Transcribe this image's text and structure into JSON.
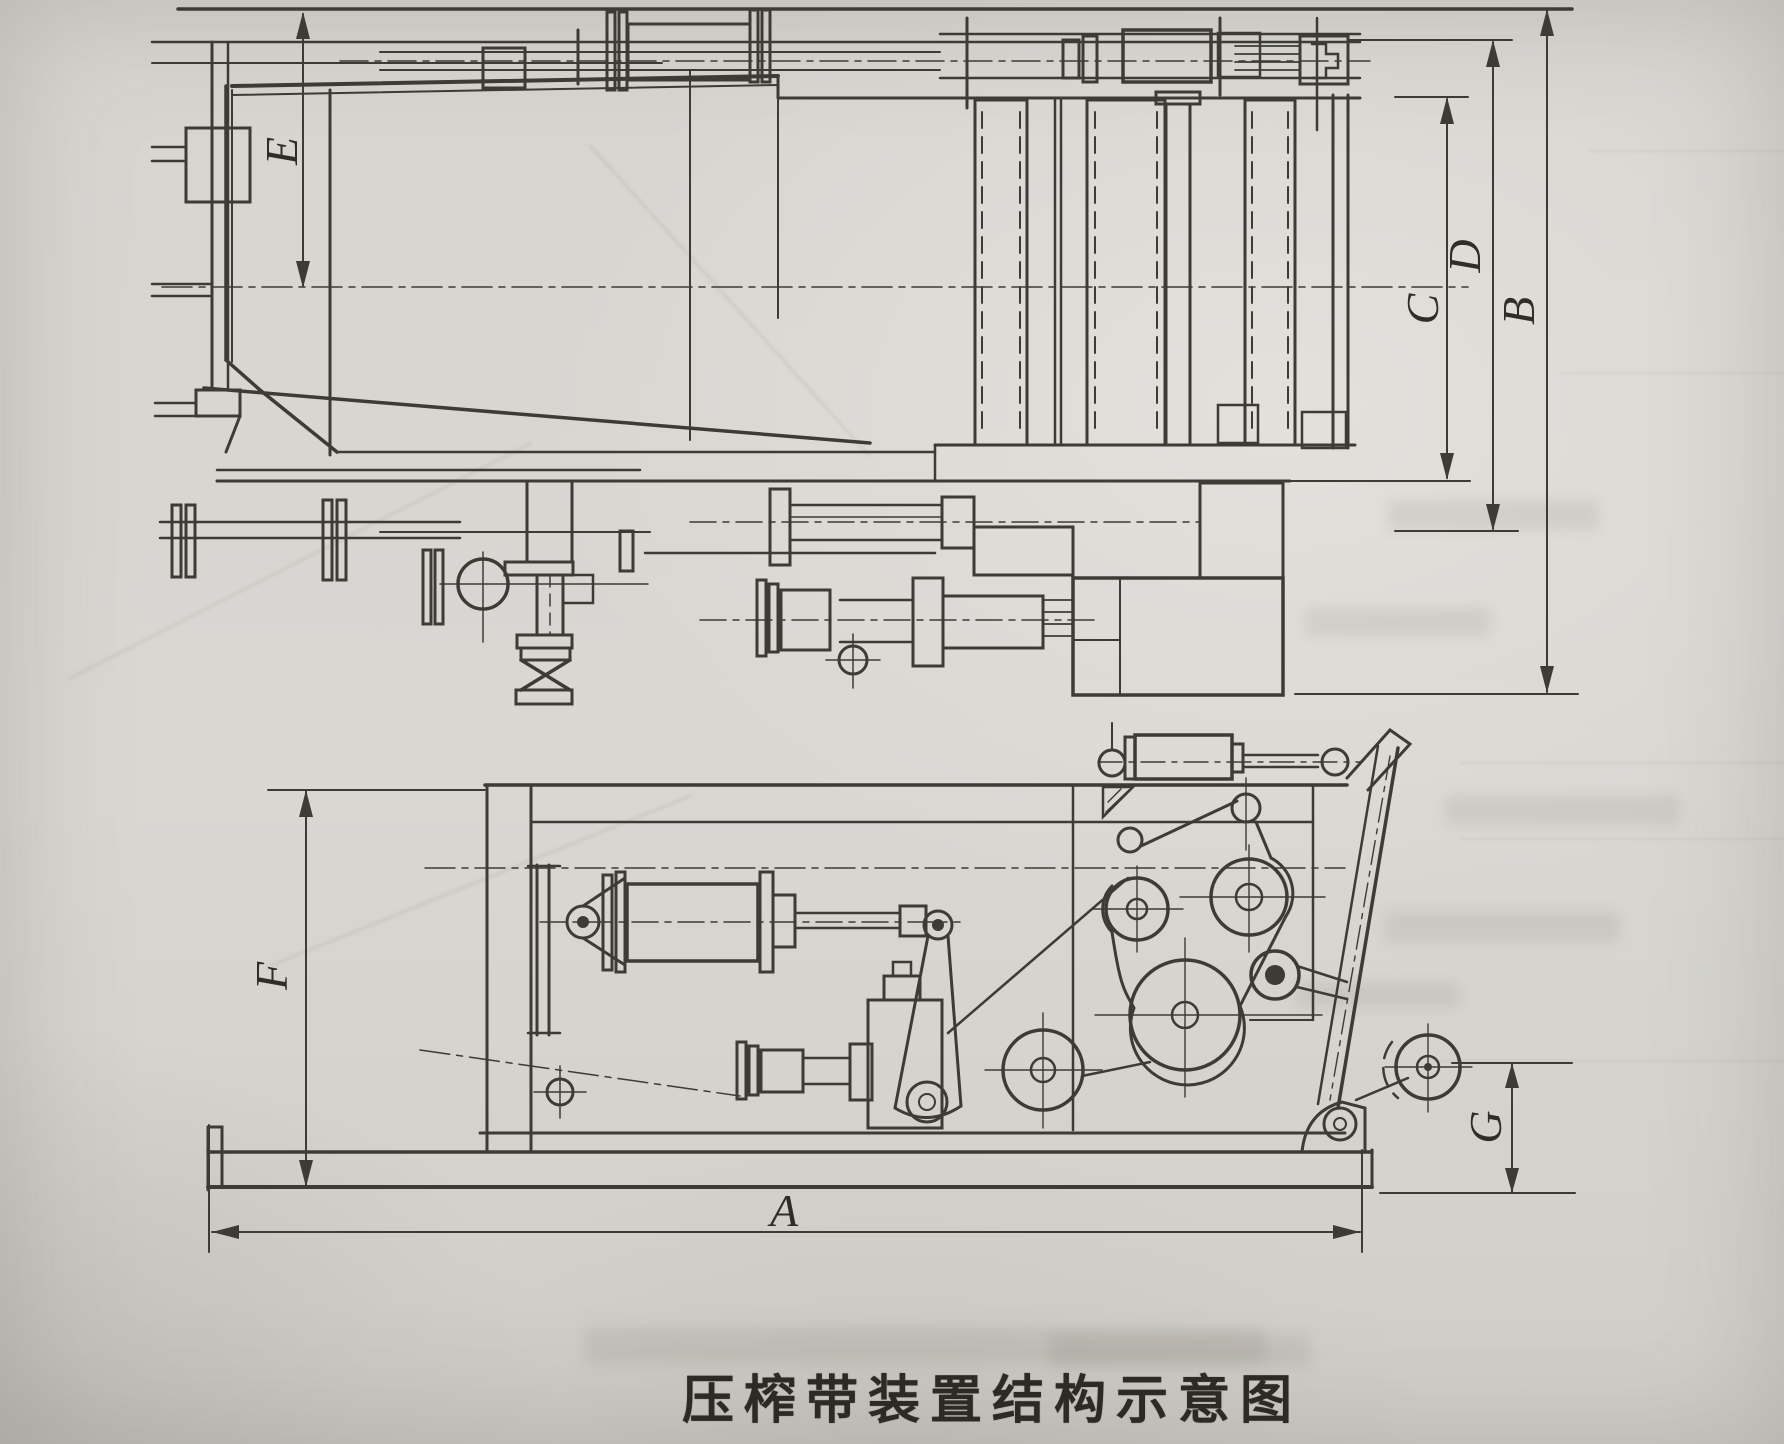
{
  "figure": {
    "caption": "压榨带装置结构示意图",
    "dimension_labels": {
      "A": "A",
      "B": "B",
      "C": "C",
      "D": "D",
      "E": "E",
      "F": "F",
      "G": "G"
    }
  },
  "colors": {
    "paper": "#d7d5d0",
    "ink": "#3c3b36",
    "caption_ink": "#2b2a24"
  }
}
